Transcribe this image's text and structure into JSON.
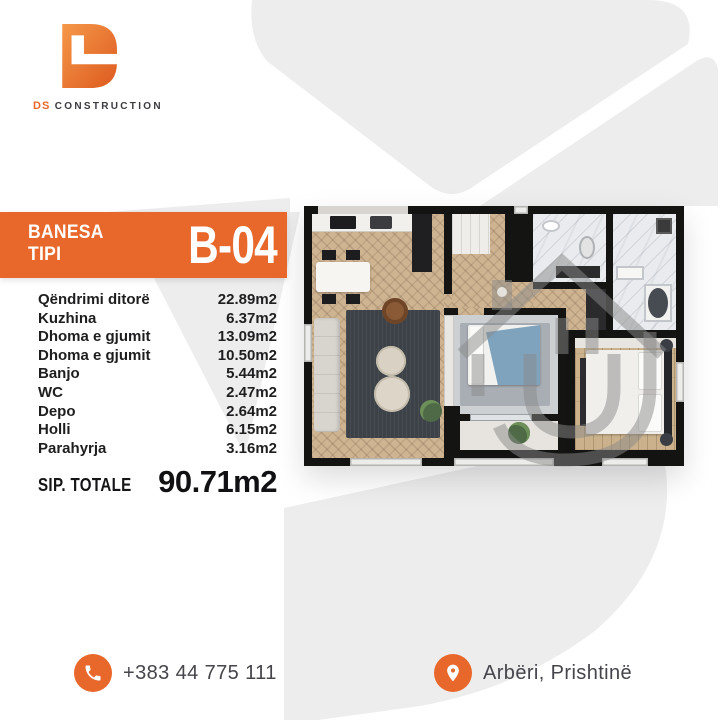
{
  "brand": {
    "logo_icon": "ds-monogram-icon",
    "name_accent": "DS",
    "name_rest": "CONSTRUCTION"
  },
  "banner": {
    "title_line1": "BANESA",
    "title_line2": "TIPI",
    "unit_code": "B-04"
  },
  "rooms": [
    {
      "label": "Qëndrimi ditorë",
      "area": "22.89m2"
    },
    {
      "label": "Kuzhina",
      "area": "6.37m2"
    },
    {
      "label": "Dhoma e gjumit",
      "area": "13.09m2"
    },
    {
      "label": "Dhoma e gjumit",
      "area": "10.50m2"
    },
    {
      "label": "Banjo",
      "area": "5.44m2"
    },
    {
      "label": "WC",
      "area": "2.47m2"
    },
    {
      "label": "Depo",
      "area": "2.64m2"
    },
    {
      "label": "Holli",
      "area": "6.15m2"
    },
    {
      "label": "Parahyrja",
      "area": "3.16m2"
    }
  ],
  "total": {
    "label": "SIP. TOTALE",
    "value": "90.71m2"
  },
  "contact": {
    "phone": "+383 44 775 111",
    "location": "Arbëri, Prishtinë"
  },
  "colors": {
    "accent_orange": "#e8682b",
    "text_dark": "#1b1b1d",
    "watermark_gray": "#ededee",
    "wall_black": "#141413",
    "floor_tan": "#cfb492"
  }
}
